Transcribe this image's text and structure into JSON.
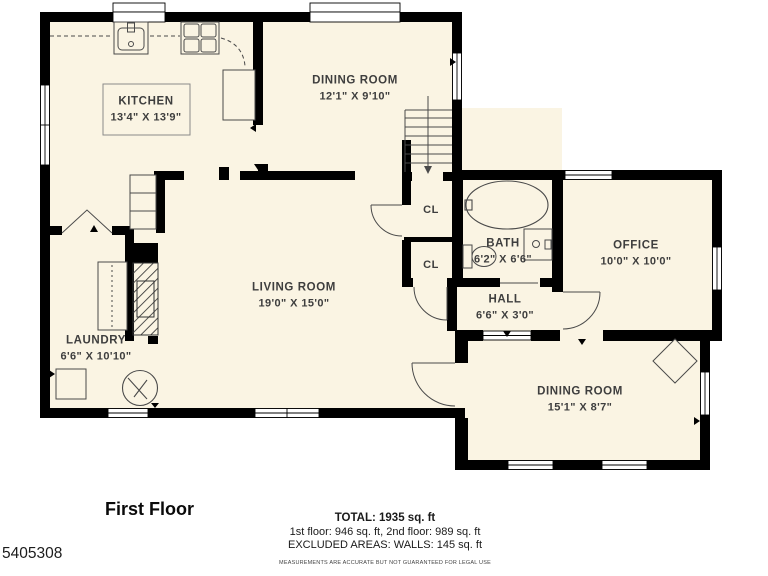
{
  "colors": {
    "background": "#ffffff",
    "floor": "#faf4e3",
    "wall": "#000000",
    "fixture_line": "#4a4a4a",
    "label_text": "#3e3e3e"
  },
  "plan": {
    "rooms": [
      {
        "id": "kitchen",
        "name": "KITCHEN",
        "dims": "13'4\" X 13'9\""
      },
      {
        "id": "dining-room-top",
        "name": "DINING ROOM",
        "dims": "12'1\" X 9'10\""
      },
      {
        "id": "living-room",
        "name": "LIVING ROOM",
        "dims": "19'0\" X 15'0\""
      },
      {
        "id": "laundry",
        "name": "LAUNDRY",
        "dims": "6'6\" X 10'10\""
      },
      {
        "id": "bath",
        "name": "BATH",
        "dims": "6'2\" X 6'6\""
      },
      {
        "id": "hall",
        "name": "HALL",
        "dims": "6'6\" X 3'0\""
      },
      {
        "id": "office",
        "name": "OFFICE",
        "dims": "10'0\" X 10'0\""
      },
      {
        "id": "dining-room-bottom",
        "name": "DINING ROOM",
        "dims": "15'1\" X 8'7\""
      }
    ],
    "closets": [
      {
        "label": "CL"
      },
      {
        "label": "CL"
      }
    ],
    "fixtures": [
      "kitchen-sink",
      "stove",
      "corner-cabinet",
      "kitchen-table",
      "staircase",
      "basement-stairs",
      "bathtub",
      "toilet",
      "vanity-sink",
      "washer",
      "laundry-unit",
      "laundry-counter",
      "chimney",
      "corner-table"
    ]
  },
  "footer": {
    "floor_label": "First Floor",
    "total": "TOTAL: 1935 sq. ft",
    "breakdown": "1st floor: 946 sq. ft, 2nd floor: 989 sq. ft",
    "excluded": "EXCLUDED AREAS: WALLS: 145 sq. ft",
    "disclaimer": "MEASUREMENTS ARE ACCURATE BUT NOT GUARANTEED FOR LEGAL USE",
    "listing_id": "5405308"
  }
}
